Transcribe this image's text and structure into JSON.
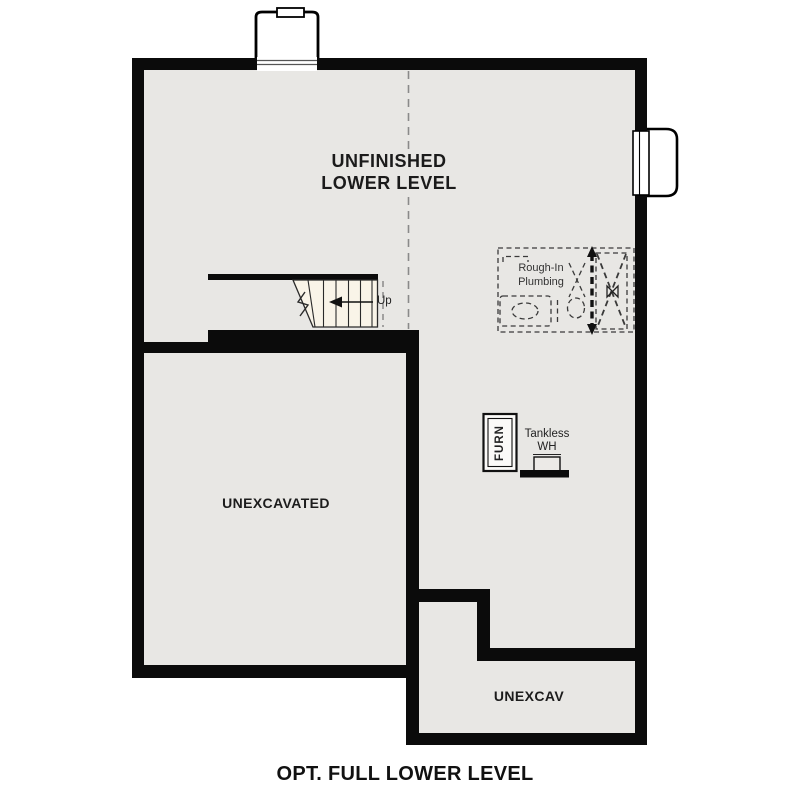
{
  "plan": {
    "caption": "OPT. FULL LOWER LEVEL",
    "rooms": {
      "unfinished_line1": "UNFINISHED",
      "unfinished_line2": "LOWER LEVEL",
      "unexcavated": "UNEXCAVATED",
      "unexcav": "UNEXCAV"
    },
    "labels": {
      "up": "Up",
      "rough_in_line1": "Rough-In",
      "rough_in_line2": "Plumbing",
      "furnace": "FURN",
      "tankless_line1": "Tankless",
      "tankless_line2": "WH"
    },
    "colors": {
      "wall": "#0b0b0b",
      "floor": "#e8e7e4",
      "stair_fill": "#f9f4e8",
      "dashed_line": "#8a8a8a",
      "plumbing_dash": "#3a3a3a",
      "text": "#1c1c1c",
      "background": "#ffffff"
    }
  }
}
